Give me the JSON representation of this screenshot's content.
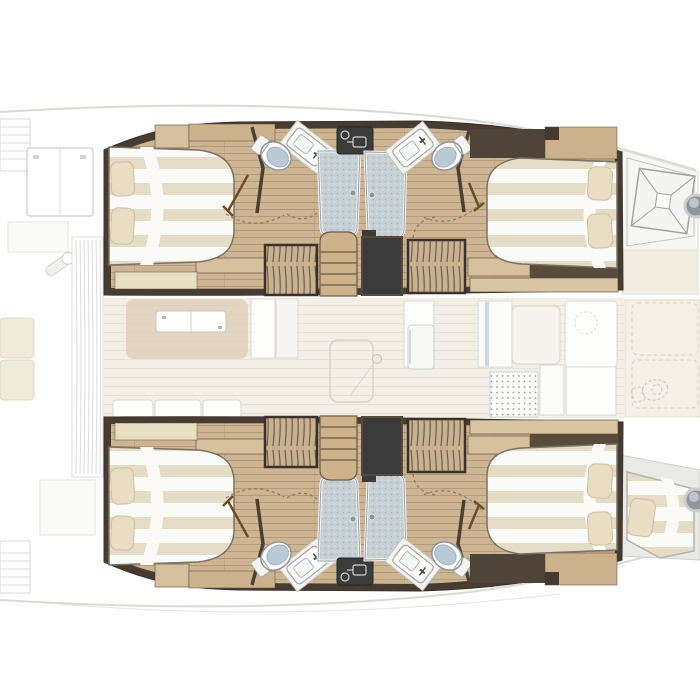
{
  "page": {
    "title": "Catamaran interior layout floorplan",
    "view": "top-down deck plan",
    "bow_direction": "right",
    "stern_direction": "left"
  },
  "palette": {
    "wall_wood_dark": "#473c31",
    "wall_wood_mid": "#5a4c3d",
    "charcoal": "#3b3b3b",
    "floor_wood": "#cdb493",
    "floor_wood_light": "#d6c09e",
    "shelf_cream": "#e9dfc4",
    "bed_white": "#fafaf6",
    "bed_stripe": "#e5dcc7",
    "pillow": "#e9ddc3",
    "shower_blue": "#c6cfd3",
    "toilet_seat_blue": "#b9cad6",
    "saloon_floor": "#f3efe7",
    "lounge_tan": "#dccdb6",
    "faded_line": "#d9d9d5",
    "accent_blue": "#cdd8e2"
  },
  "hulls": [
    {
      "id": "port-hull",
      "position": "top",
      "rooms": [
        {
          "name": "aft-cabin",
          "items": [
            "double-berth",
            "pillow",
            "pillow",
            "shelf",
            "shelf"
          ]
        },
        {
          "name": "aft-bathroom",
          "items": [
            "toilet",
            "washbasin",
            "shower-stall",
            "door-swing"
          ]
        },
        {
          "name": "companionway",
          "items": [
            "stairs",
            "entry-landing",
            "louvered-locker",
            "louvered-locker"
          ]
        },
        {
          "name": "forward-bathroom",
          "items": [
            "shower-stall",
            "washbasin",
            "toilet",
            "door-swing"
          ]
        },
        {
          "name": "forward-cabin",
          "items": [
            "double-berth",
            "pillow",
            "pillow",
            "shelf"
          ]
        },
        {
          "name": "foredeck",
          "items": [
            "deck-hatch",
            "porthole"
          ]
        }
      ]
    },
    {
      "id": "starboard-hull",
      "position": "bottom",
      "rooms": [
        {
          "name": "aft-cabin",
          "items": [
            "double-berth",
            "pillow",
            "pillow",
            "shelf",
            "shelf"
          ]
        },
        {
          "name": "aft-bathroom",
          "items": [
            "toilet",
            "washbasin",
            "shower-stall",
            "door-swing"
          ]
        },
        {
          "name": "companionway",
          "items": [
            "stairs",
            "entry-landing",
            "louvered-locker",
            "louvered-locker"
          ]
        },
        {
          "name": "forward-bathroom",
          "items": [
            "shower-stall",
            "washbasin",
            "toilet",
            "door-swing"
          ]
        },
        {
          "name": "forward-cabin",
          "items": [
            "double-berth",
            "pillow",
            "pillow",
            "shelf"
          ]
        },
        {
          "name": "forepeak",
          "items": [
            "skipper-berth",
            "pillow",
            "porthole"
          ]
        }
      ]
    }
  ],
  "bridgedeck_faded": {
    "aft_cockpit": [
      "transom-steps",
      "transom-steps",
      "cockpit-table",
      "helm-fitting",
      "bench-cushions",
      "louvered-bench"
    ],
    "saloon": [
      "lounge-sofa",
      "saloon-table",
      "cabinets",
      "sliding-door",
      "sofa-cushions"
    ],
    "galley": [
      "tall-cabinet",
      "refrigerator",
      "counters",
      "sink-drainer",
      "accent-door-strip"
    ],
    "foredeck": [
      "locker-panel",
      "locker-panel",
      "bow-head-toilet-outline"
    ]
  }
}
